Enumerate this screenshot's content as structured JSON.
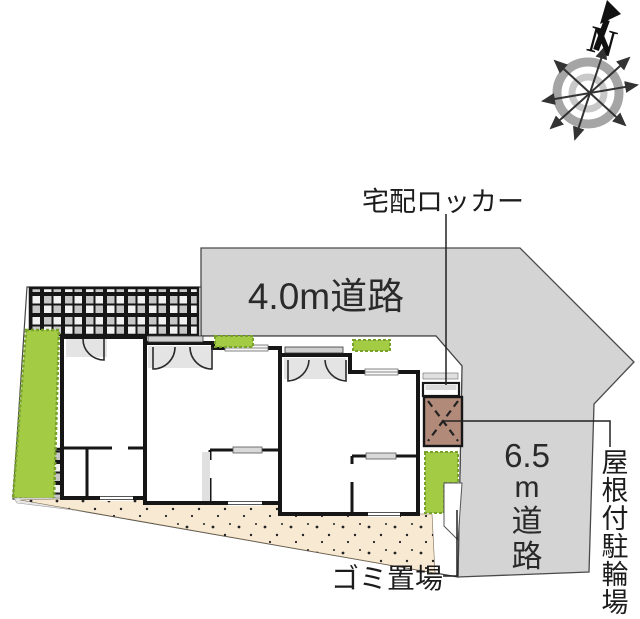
{
  "compass": {
    "north_letter": "N"
  },
  "labels": {
    "delivery_locker": {
      "text": "宅配ロッカー"
    },
    "garbage": {
      "text": "ゴミ置場"
    },
    "bike_parking": {
      "text": "屋根付駐輪場",
      "chars": [
        "屋",
        "根",
        "付",
        "駐",
        "輪",
        "場"
      ]
    }
  },
  "roads": {
    "top": {
      "label": "4.0m道路"
    },
    "right": {
      "label": "6.5m道路",
      "label_lines": [
        "6.5",
        "m",
        "道",
        "路"
      ]
    }
  },
  "colors": {
    "road": "#d4d4d4",
    "road_edge": "#4a4a4a",
    "parcel": "#ffffff",
    "green": "#a3cb44",
    "green_edge": "#78a22c",
    "walkway": "#f7e9d2",
    "bike_roof": "#b28a79",
    "checker_dark": "#c7c7c7",
    "checker_light": "#f1f1f1",
    "porch_gray": "#e4e4e4",
    "pad_gray": "#e7e7e7"
  }
}
